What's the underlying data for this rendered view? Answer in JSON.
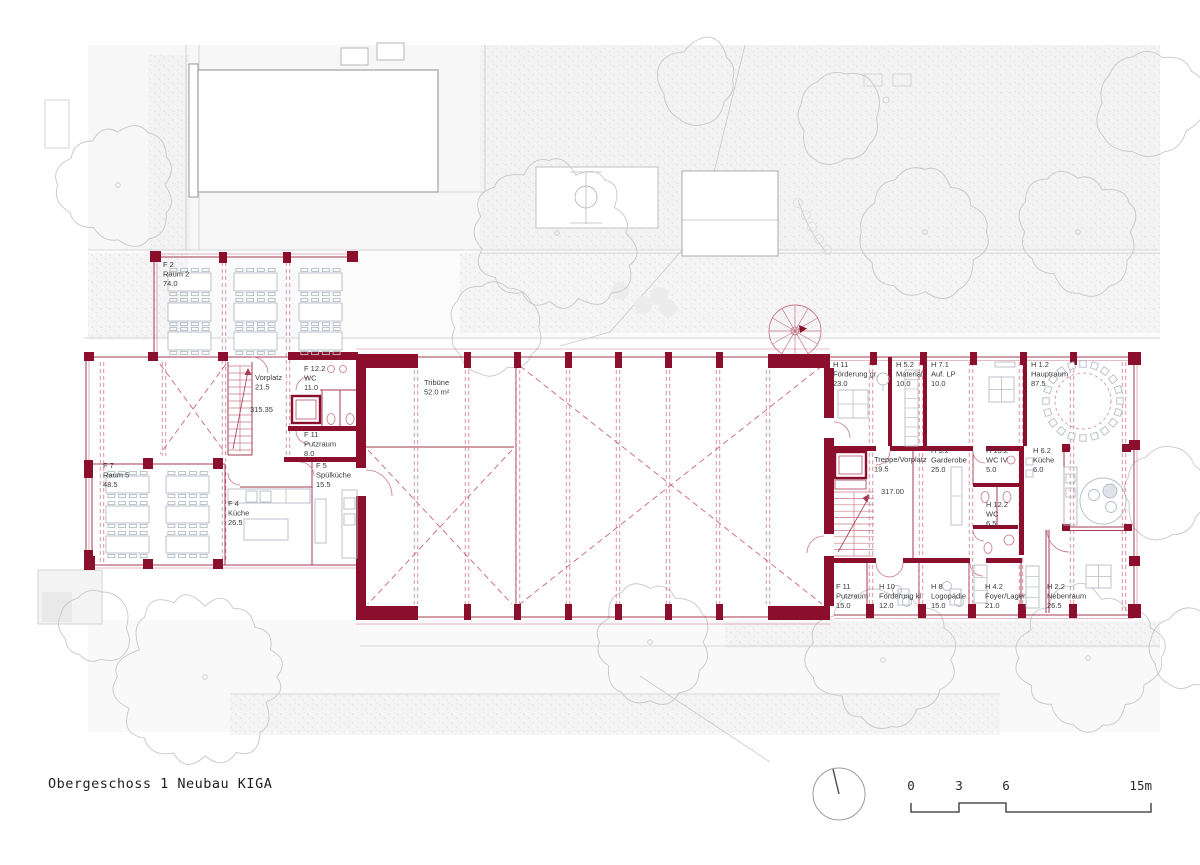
{
  "footer": {
    "title": "Obergeschoss 1 Neubau KIGA",
    "scale": {
      "s0": "0",
      "s3": "3",
      "s6": "6",
      "s15": "15m"
    }
  },
  "icons": {
    "north_arrow": "north-arrow",
    "scale_bar": "scale-bar"
  },
  "plan": {
    "rooms": [
      {
        "code": "F 2",
        "name": "Raum 2",
        "area": "74.0"
      },
      {
        "code": "",
        "name": "Vorplatz",
        "area": "21.5"
      },
      {
        "code": "F 12.2",
        "name": "WC",
        "area": "11.0"
      },
      {
        "code": "F 11",
        "name": "Putzraum",
        "area": "8.0"
      },
      {
        "code": "F 5",
        "name": "Spülküche",
        "area": "15.5"
      },
      {
        "code": "F 7",
        "name": "Raum 5",
        "area": "48.5"
      },
      {
        "code": "F 4",
        "name": "Küche",
        "area": "26.5"
      },
      {
        "code": "",
        "name": "Tribüne",
        "area": "52.0 m²"
      },
      {
        "code": "H 11",
        "name": "Förderung gr.",
        "area": "23.0"
      },
      {
        "code": "H 5.2",
        "name": "Material",
        "area": "10.0"
      },
      {
        "code": "H 7.1",
        "name": "Auf. LP",
        "area": "10.0"
      },
      {
        "code": "H 1.2",
        "name": "Hauptraum",
        "area": "87.5"
      },
      {
        "code": "",
        "name": "Treppe/Vorplatz",
        "area": "19.5"
      },
      {
        "code": "H 3.2",
        "name": "Garderobe",
        "area": "25.0"
      },
      {
        "code": "H 13.2",
        "name": "WC IV",
        "area": "5.0"
      },
      {
        "code": "H 6.2",
        "name": "Küche",
        "area": "6.0"
      },
      {
        "code": "H 12.2",
        "name": "WC",
        "area": "6.5"
      },
      {
        "code": "F 11",
        "name": "Putzraum",
        "area": "15.0"
      },
      {
        "code": "H 10",
        "name": "Förderung kl.",
        "area": "12.0"
      },
      {
        "code": "H 8",
        "name": "Logopädie",
        "area": "15.0"
      },
      {
        "code": "H 4.2",
        "name": "Foyer/Lager",
        "area": "21.0"
      },
      {
        "code": "H 2.2",
        "name": "Nebenraum",
        "area": "26.5"
      }
    ],
    "levels": {
      "left": "315.35",
      "right": "317.00"
    }
  },
  "colors": {
    "wall": "#8c0e2d",
    "line": "#a63b53",
    "lineLight": "#c8788a",
    "dash": "#c9677c",
    "furniture": "#b6bcc6",
    "site": "#c9c9c9",
    "siteLight": "#dadada",
    "text": "#3a3a3a"
  }
}
